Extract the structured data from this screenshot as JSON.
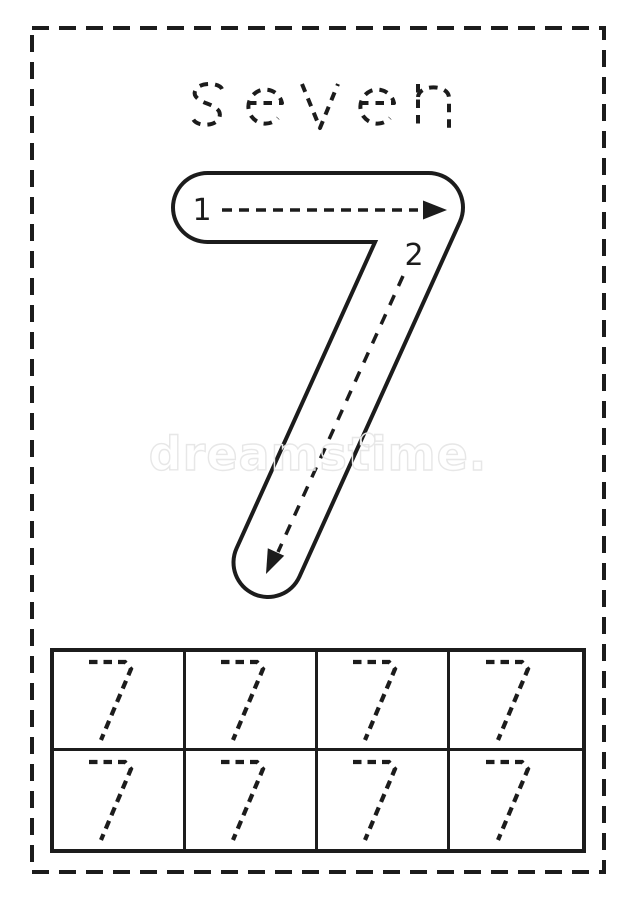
{
  "worksheet": {
    "word": "seven",
    "letters": [
      "s",
      "e",
      "v",
      "e",
      "n"
    ],
    "numeral": "7",
    "stroke_guides": [
      {
        "label": "1"
      },
      {
        "label": "2"
      }
    ],
    "practice_grid": {
      "rows": 2,
      "columns": 4,
      "cell_count": 8,
      "glyph": "7"
    },
    "watermark": {
      "text": "dreamstime."
    },
    "colors": {
      "ink": "#1c1c1c",
      "paper": "#ffffff",
      "watermark": "#e7e7e7"
    }
  }
}
